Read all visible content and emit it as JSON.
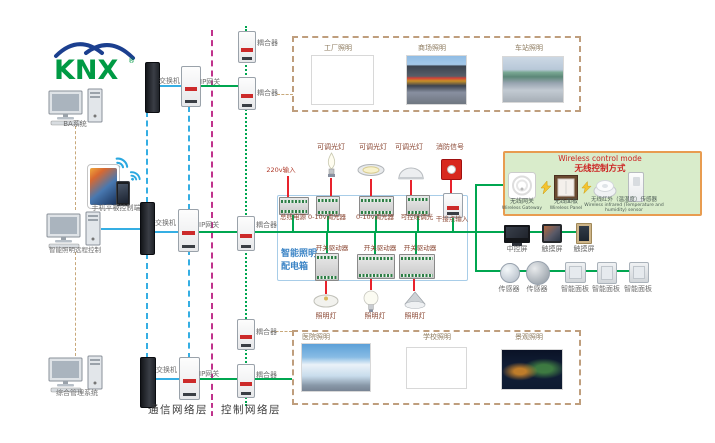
{
  "logo": {
    "text": "KNX"
  },
  "left_column": {
    "computer_top_label": "BA系统",
    "mobile_label": "手机平板控制端",
    "computer_mid_label": "智能照明远程控制",
    "computer_bottom_label": "综合管理系统"
  },
  "network": {
    "switch_label": "交换机",
    "gateway_label": "IP网关",
    "coupler_label": "耦合器"
  },
  "layers": {
    "communication": "通信网络层",
    "control": "控制网络层"
  },
  "cabinet": {
    "title_line1": "智能照明",
    "title_line2": "配电箱",
    "power_input_label": "220v输入",
    "dimmable_lamp_label": "可调光灯",
    "fire_signal_label": "消防信号",
    "modules_row1": [
      "总线电源",
      "0-10v调光器",
      "0-10v调光器",
      "可控硅调光",
      "干接点输入"
    ],
    "switch_actuator_label": "开关驱动器",
    "lamp_label": "照明灯"
  },
  "wireless": {
    "title_en": "Wireless control mode",
    "title_cn": "无线控制方式",
    "gateway_cn": "无线网关",
    "gateway_en": "Wireless Gateway",
    "panel_cn": "无线面板",
    "panel_en": "Wireless Panel",
    "sensor_cn": "无线红外（温湿度）传感器",
    "sensor_en": "Wireless infrared (Temperature and humidity) sensor"
  },
  "right_devices": {
    "central_screen_label": "中控屏",
    "touch_screen_label": "触摸屏",
    "sensor_label": "传感器",
    "smart_panel_label": "智能面板"
  },
  "buildings": {
    "top": [
      "工厂照明",
      "商场照明",
      "车站照明"
    ],
    "bottom": [
      "医院照明",
      "学校照明",
      "景观照明"
    ]
  },
  "colors": {
    "bus_green": "#00a650",
    "lan_blue": "#35aee3",
    "backbone_purple": "#c0328c",
    "link_brown": "#c8a87a",
    "power_red": "#e8232d"
  }
}
